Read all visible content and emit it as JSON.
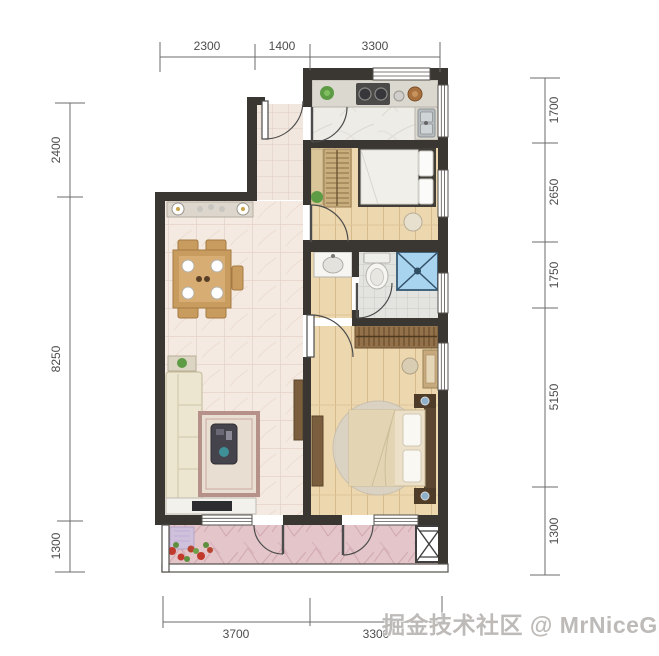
{
  "watermark": {
    "text": "掘金技术社区 @ MrNiceGuy"
  },
  "dimensions": {
    "top": [
      "2300",
      "1400",
      "3300"
    ],
    "left": [
      "2400",
      "8250",
      "1300"
    ],
    "right": [
      "1700",
      "2650",
      "1750",
      "5150",
      "1300"
    ],
    "bottom": [
      "3700",
      "3300"
    ]
  },
  "colors": {
    "wall": "#3a3733",
    "dim_line": "#6b6b6b",
    "dim_text": "#4c4c4c",
    "tile_floor": "#f4eae1",
    "wood_floor": "#ecd7ae",
    "kitchen_floor": "#edece7",
    "bath_floor": "#e3e3e0",
    "balcony_floor": "#e3c5ca",
    "shower_blue": "#a9d4f0",
    "watermark_gray": "#bdbab8"
  }
}
